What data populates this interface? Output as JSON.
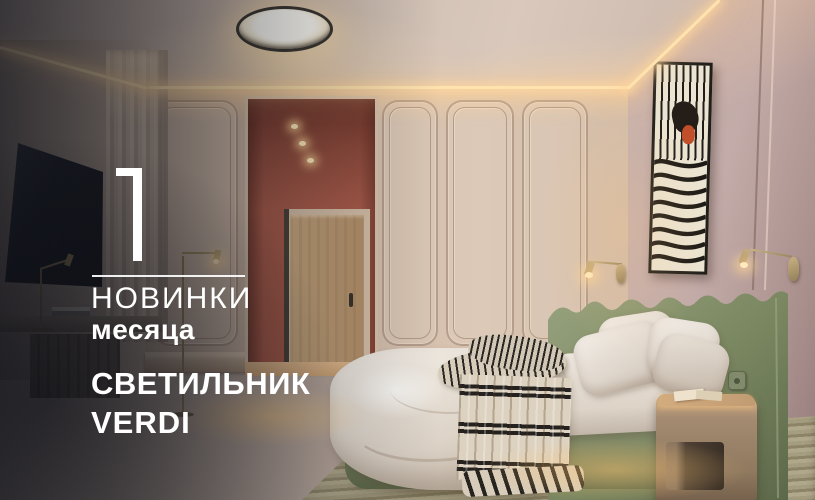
{
  "banner": {
    "number": "11",
    "heading": "НОВИНКИ",
    "subheading": "месяца",
    "product_line1": "СВЕТИЛЬНИК",
    "product_line2": "VERDI"
  },
  "scene": {
    "colors": {
      "text": "#ffffff",
      "terracotta_wall": "#a85a48",
      "wall_beige": "#d3c0b0",
      "wall_mauve": "#c2aba8",
      "headboard_green": "#87926f",
      "brass_lamp": "#b09a6a",
      "floor_wood": "#bf9a72",
      "overlay_dark": "#10121c"
    }
  }
}
